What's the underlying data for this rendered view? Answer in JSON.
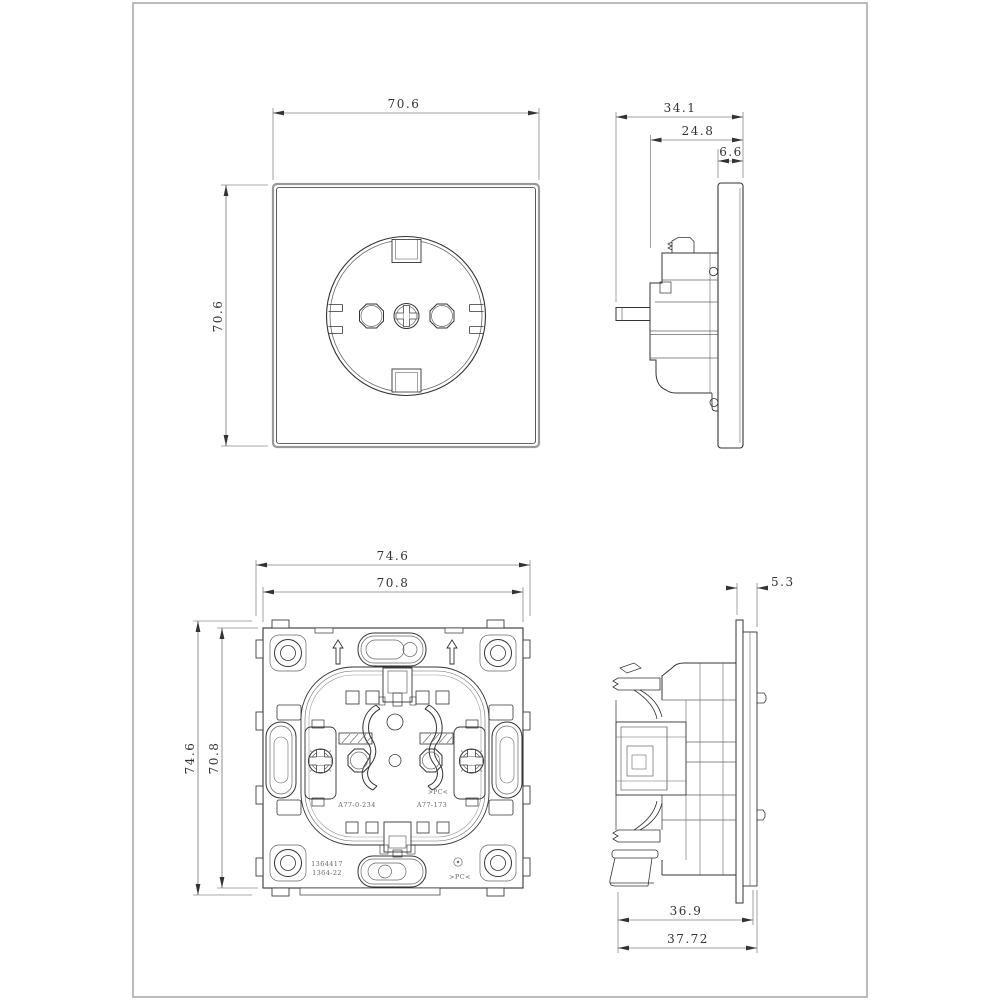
{
  "drawing": {
    "type": "technical-orthographic-views",
    "subject": "schuko-socket-insert",
    "views": [
      "faceplate-front",
      "faceplate-side",
      "mechanism-back",
      "mechanism-side"
    ]
  },
  "dims": {
    "front_width": "70.6",
    "front_height": "70.6",
    "side_depth_total": "34.1",
    "side_depth_body": "24.8",
    "side_plate_thickness": "6.6",
    "back_outer_width": "74.6",
    "back_inner_width": "70.8",
    "back_outer_height": "74.6",
    "back_inner_height": "70.8",
    "mech_flange_depth": "5.3",
    "mech_body_depth": "36.9",
    "mech_total_depth": "37.72"
  },
  "annotations": {
    "part_number_left": "A77-0-234",
    "part_number_right": "A77-173",
    "material_marking_center": ">PC<",
    "material_marking_bottom": ">PC<",
    "code_line1": "1364417",
    "code_line2": "1364-22"
  },
  "colors": {
    "background": "#ffffff",
    "frame_border": "#a8a8a8",
    "drawing_line": "#333333",
    "dimension_line": "#444444",
    "plate_edge": "#999999"
  }
}
